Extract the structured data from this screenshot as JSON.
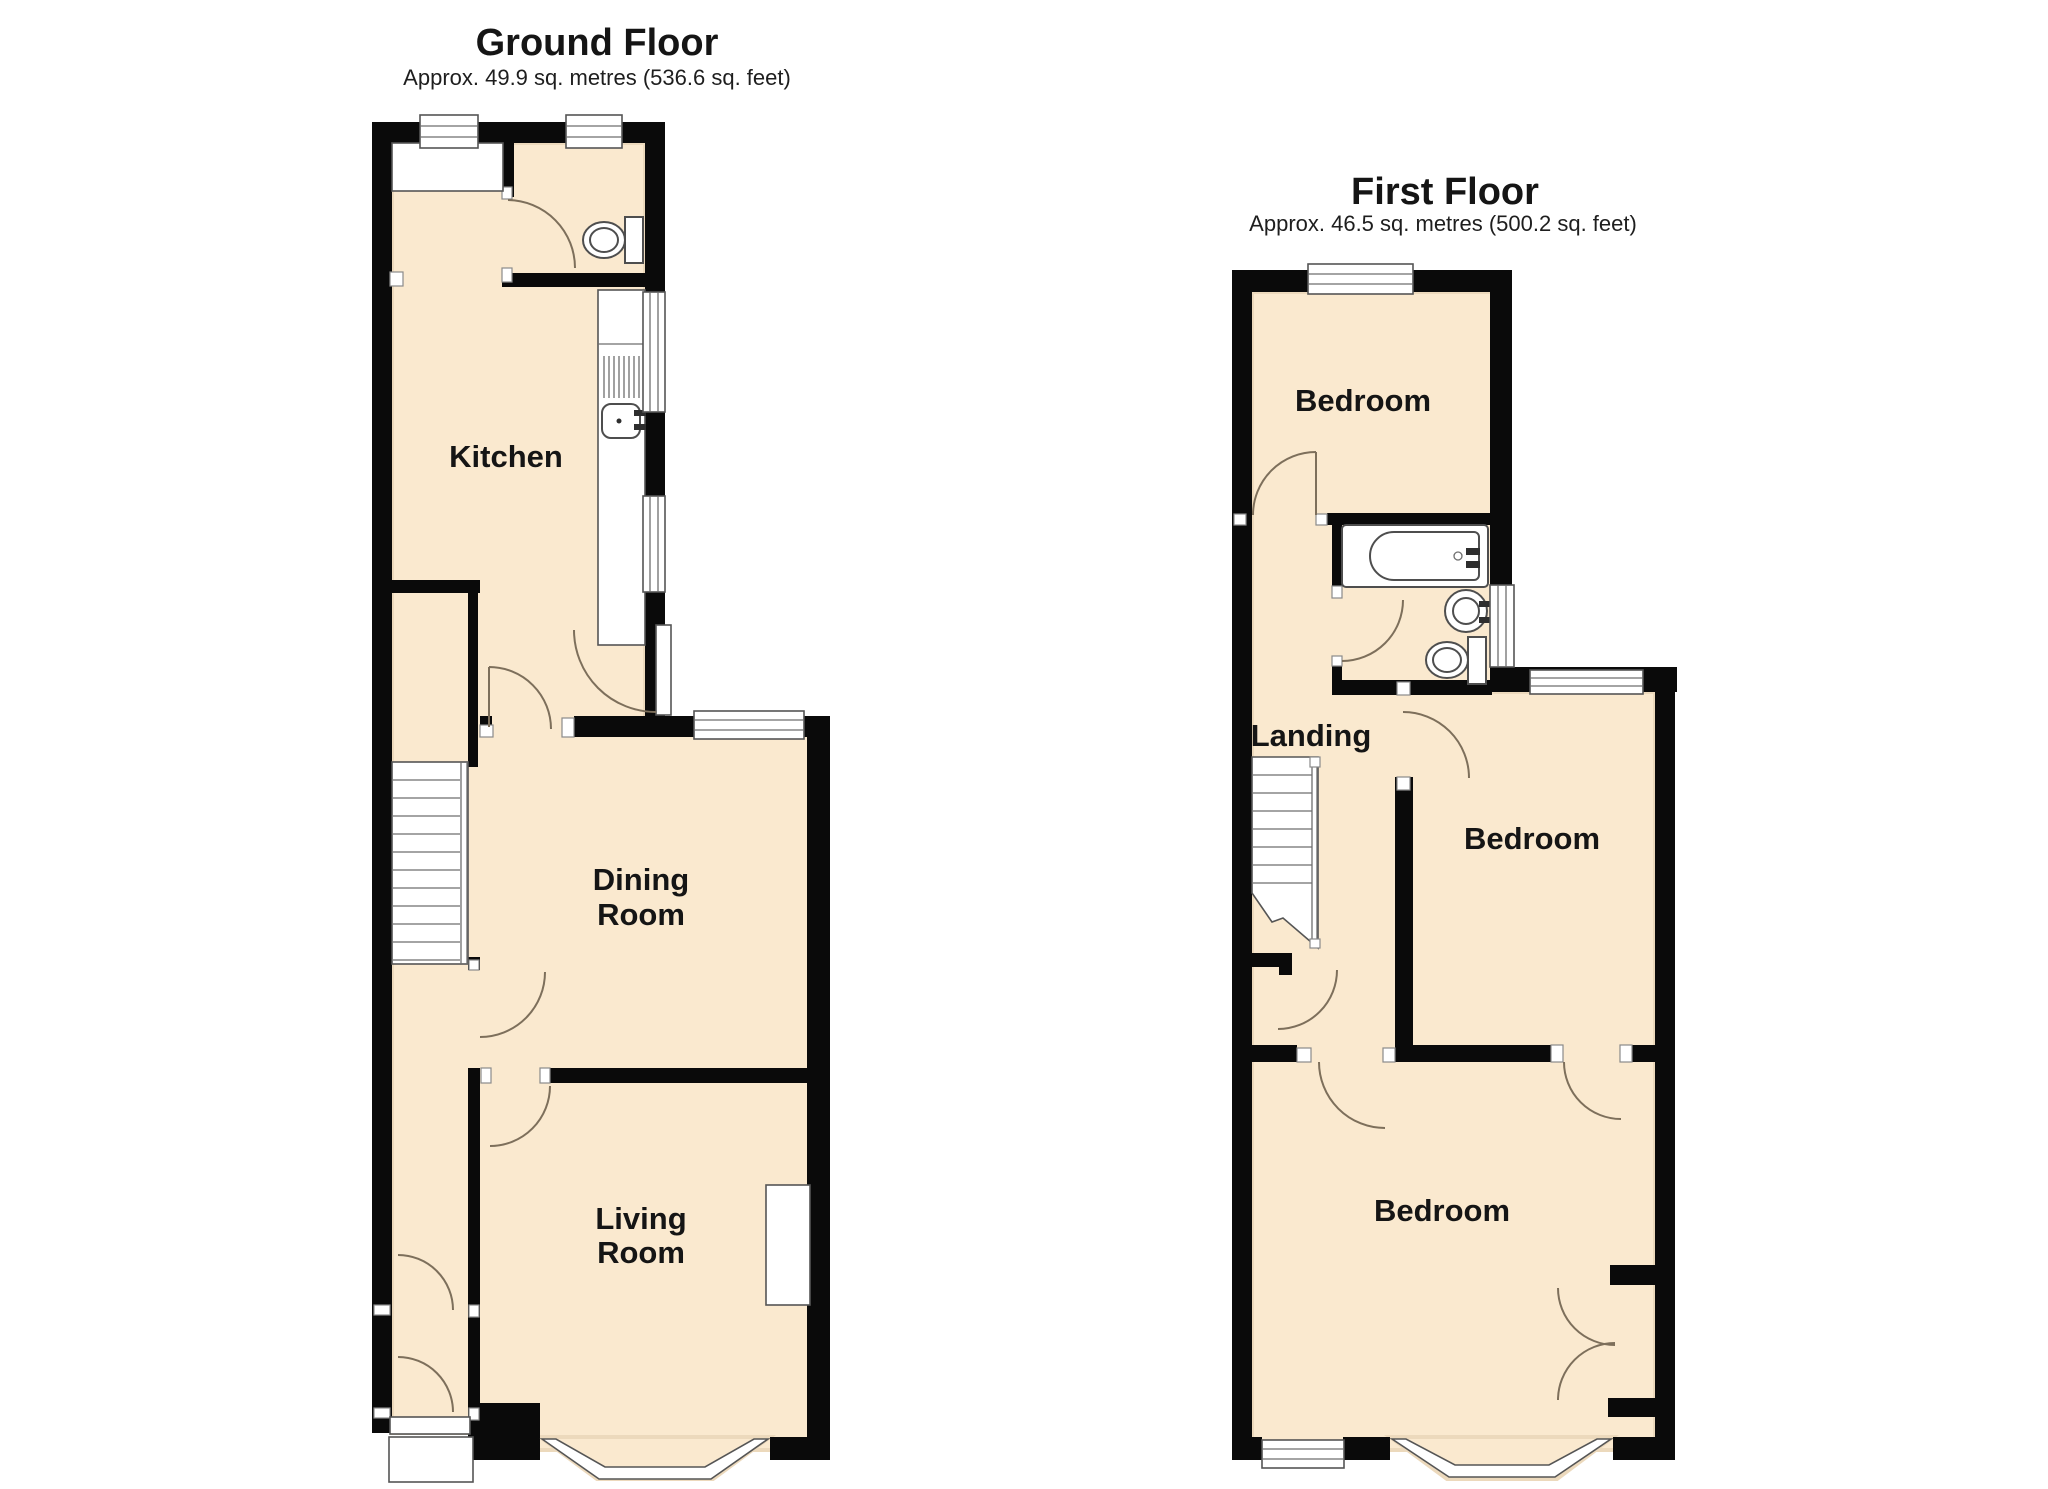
{
  "ground_floor": {
    "title": "Ground Floor",
    "subtitle": "Approx. 49.9 sq. metres (536.6 sq. feet)",
    "labels": {
      "kitchen": "Kitchen",
      "dining_line1": "Dining",
      "dining_line2": "Room",
      "living_line1": "Living",
      "living_line2": "Room"
    }
  },
  "first_floor": {
    "title": "First Floor",
    "subtitle": "Approx. 46.5 sq. metres (500.2 sq. feet)",
    "labels": {
      "bedroom_front": "Bedroom",
      "landing": "Landing",
      "bedroom_middle": "Bedroom",
      "bedroom_rear": "Bedroom"
    }
  },
  "colors": {
    "wall": "#0a0a0a",
    "floor": "#fae9cf",
    "line": "#555555",
    "door_arc": "#7d6f5b",
    "background": "#ffffff"
  }
}
